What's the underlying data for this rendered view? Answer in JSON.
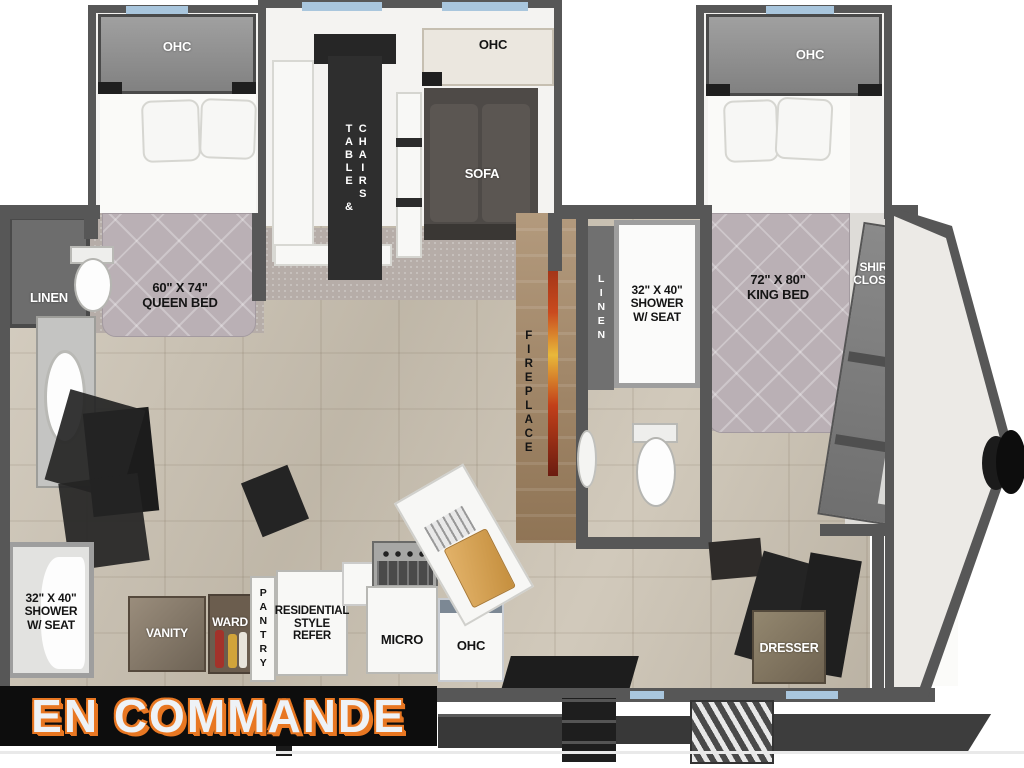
{
  "image_type": "rv-floorplan-render",
  "banner": {
    "text": "EN COMMANDE"
  },
  "labels": {
    "ohc_bed_left": "OHC",
    "ohc_living": "OHC",
    "ohc_bed_front": "OHC",
    "ohc_kitchen": "OHC",
    "table_chairs": "TABLE &\nCHAIRS",
    "sofa": "SOFA",
    "linen_rear": "LINEN",
    "linen_mid": "LINEN",
    "queen_bed": "60\" X 74\"\nQUEEN BED",
    "king_bed": "72\" X 80\"\nKING BED",
    "shower_rear": "32\" X 40\"\nSHOWER\nW/ SEAT",
    "shower_mid": "32\" X 40\"\nSHOWER\nW/ SEAT",
    "fireplace": "FIREPLACE",
    "vanity": "VANITY",
    "ward": "WARD",
    "pantry": "PANTRY",
    "refer": "RESIDENTIAL\nSTYLE\nREFER",
    "micro": "MICRO",
    "dresser": "DRESSER",
    "shirt_closet": "SHIRT\nCLOSET",
    "wd_prep": "W/D\nPREP"
  },
  "colors": {
    "banner_bg": "#0D0D0D",
    "banner_text": "#EEF2F6",
    "banner_outline": "#E87722",
    "wall": "#575757",
    "floor": "#CBC2B2",
    "carpet": "#B6ADA8",
    "window": "#A9C6DD",
    "mattress": "#BAB0B5",
    "sofa": "#4E4A47",
    "flame_gradient": [
      "#7A1F12",
      "#C94A1E",
      "#E8B83A",
      "#6B1C10"
    ]
  }
}
